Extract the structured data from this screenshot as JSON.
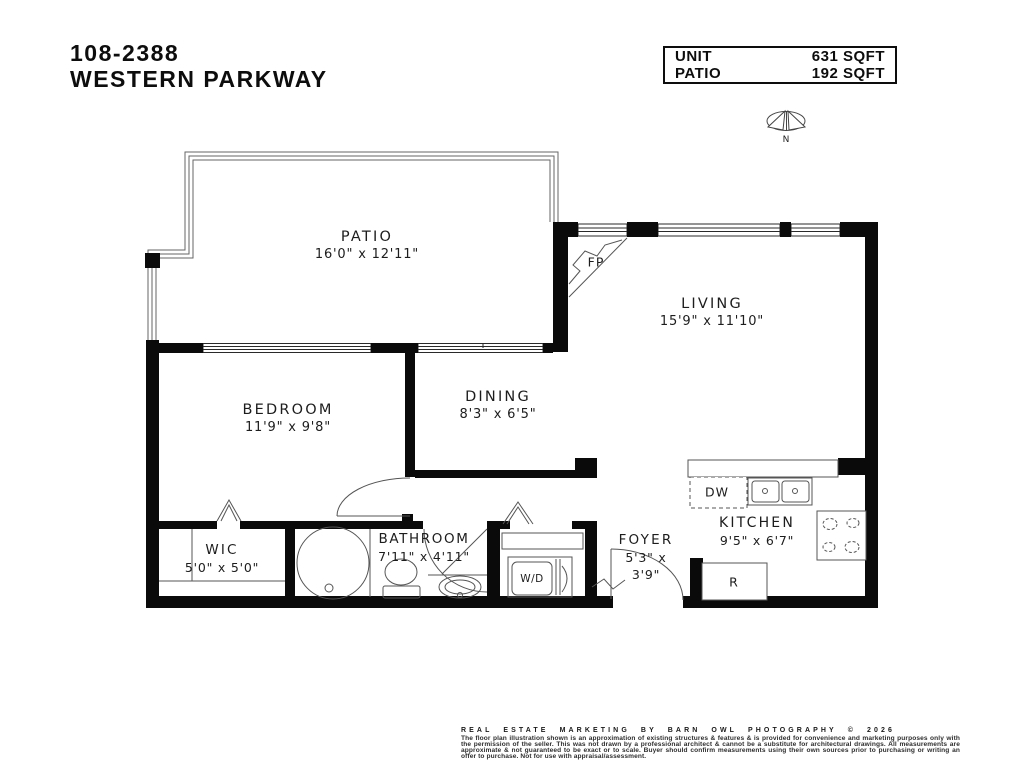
{
  "title": {
    "line1": "108-2388",
    "line2": "WESTERN PARKWAY"
  },
  "info_box": {
    "rows": [
      {
        "label": "UNIT",
        "value": "631 SQFT"
      },
      {
        "label": "PATIO",
        "value": "192 SQFT"
      }
    ]
  },
  "compass": {
    "label": "N"
  },
  "rooms": {
    "patio": {
      "name": "PATIO",
      "dims": "16'0\" x 12'11\""
    },
    "living": {
      "name": "LIVING",
      "dims": "15'9\" x 11'10\""
    },
    "dining": {
      "name": "DINING",
      "dims": "8'3\" x 6'5\""
    },
    "bedroom": {
      "name": "BEDROOM",
      "dims": "11'9\" x 9'8\""
    },
    "wic": {
      "name": "WIC",
      "dims": "5'0\" x 5'0\""
    },
    "bathroom": {
      "name": "BATHROOM",
      "dims": "7'11\" x 4'11\""
    },
    "foyer": {
      "name": "FOYER",
      "dims_line1": "5'3\" x",
      "dims_line2": "3'9\""
    },
    "kitchen": {
      "name": "KITCHEN",
      "dims": "9'5\" x 6'7\""
    }
  },
  "fixtures": {
    "fireplace": "FP",
    "dishwasher": "DW",
    "washer_dryer": "W/D",
    "refrigerator": "R"
  },
  "footer": {
    "heading": "REAL ESTATE MARKETING BY BARN OWL PHOTOGRAPHY © 2026",
    "disclaimer": "The floor plan illustration shown is an approximation of existing structures & features & is provided for convenience and marketing purposes only with the permission of the seller. This was not drawn by a professional architect & cannot be a substitute for architectural drawings. All measurements are approximate & not guaranteed to be exact or to scale. Buyer should confirm measurements using their own sources prior to purchasing or writing an offer to purchase. Not for use with appraisal/assessment."
  },
  "colors": {
    "ink": "#111111",
    "line": "#555555",
    "background": "#ffffff"
  }
}
